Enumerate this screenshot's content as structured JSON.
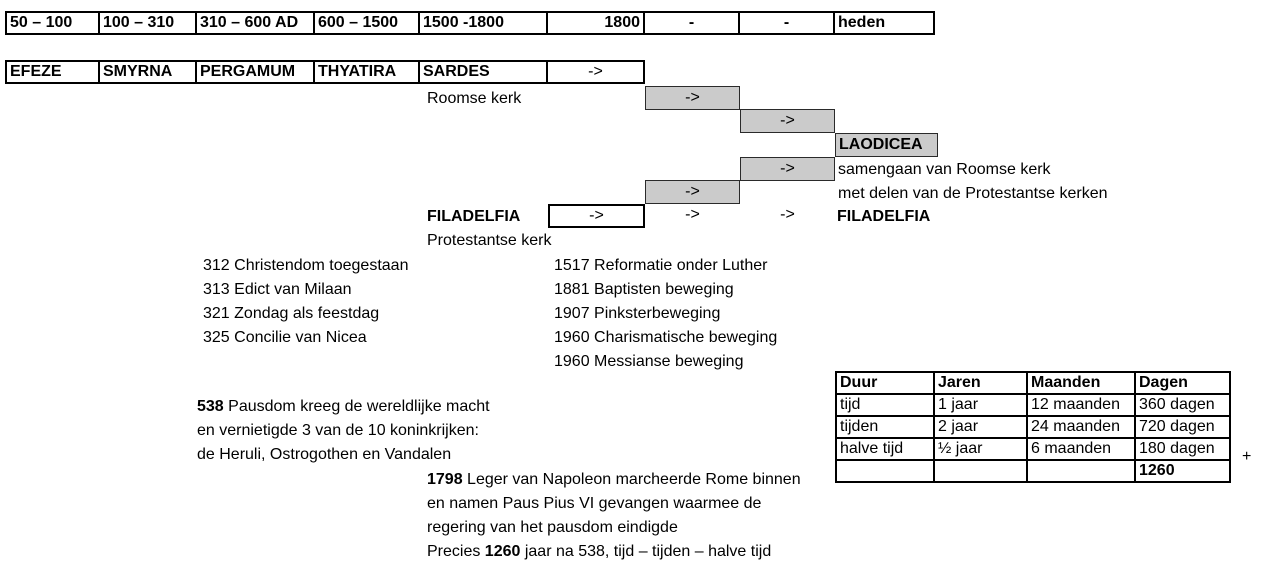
{
  "colors": {
    "box_fill": "#cbcbcb",
    "border": "#000000"
  },
  "timeline": {
    "cells": [
      "50 – 100",
      "100 – 310",
      "310 – 600 AD",
      "600 – 1500",
      "1500 -1800",
      "1800",
      "-",
      "-",
      "heden"
    ]
  },
  "churches": {
    "cells": [
      "EFEZE",
      "SMYRNA",
      "PERGAMUM",
      "THYATIRA",
      "SARDES"
    ],
    "arrow": "->"
  },
  "flow": {
    "arrow": "->",
    "roomse_kerk": "Roomse kerk",
    "laodicea": "LAODICEA",
    "samengaan_1": "samengaan van Roomse kerk",
    "samengaan_2": "met delen van de Protestantse kerken",
    "filadelfia_left": "FILADELFIA",
    "filadelfia_right": "FILADELFIA",
    "protestantse_kerk": "Protestantse kerk"
  },
  "events_310": [
    "312 Christendom toegestaan",
    "313 Edict van Milaan",
    "321 Zondag als feestdag",
    "325 Concilie van Nicea"
  ],
  "events_1500": [
    "1517 Reformatie onder Luther",
    "1881 Baptisten beweging",
    "1907 Pinksterbeweging",
    "1960 Charismatische beweging",
    "1960 Messianse beweging"
  ],
  "note_538": {
    "year": "538",
    "line1_rest": " Pausdom kreeg de wereldlijke macht",
    "line2": "en vernietigde 3 van de 10 koninkrijken:",
    "line3": "de Heruli, Ostrogothen en Vandalen"
  },
  "duur_table": {
    "headers": [
      "Duur",
      "Jaren",
      "Maanden",
      "Dagen"
    ],
    "rows": [
      [
        "tijd",
        "1 jaar",
        "12 maanden",
        "360 dagen"
      ],
      [
        "tijden",
        "2 jaar",
        "24 maanden",
        "720 dagen"
      ],
      [
        "halve tijd",
        "½ jaar",
        "6 maanden",
        "180 dagen"
      ]
    ],
    "plus": "+",
    "total": "1260"
  },
  "note_1798": {
    "year": "1798",
    "line1_rest": " Leger van Napoleon marcheerde Rome binnen",
    "line2": "en namen Paus Pius VI gevangen waarmee de",
    "line3": "regering van het pausdom eindigde",
    "line4_prefix": "Precies ",
    "line4_bold": "1260",
    "line4_rest": " jaar na 538, tijd – tijden – halve tijd"
  }
}
